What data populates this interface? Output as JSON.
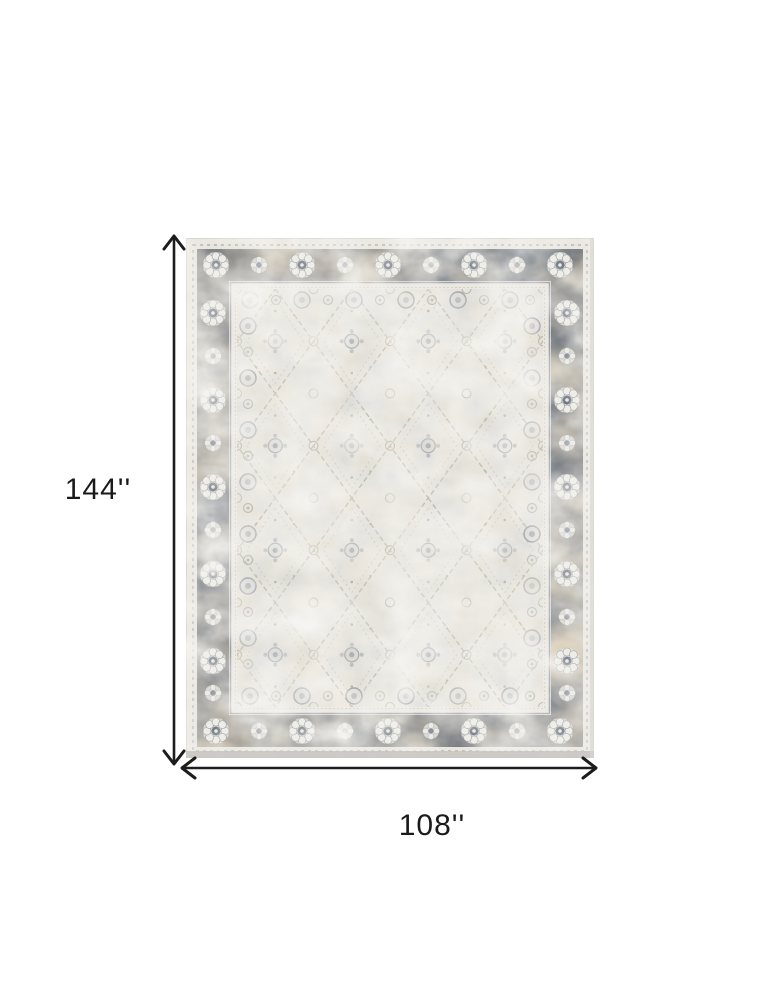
{
  "page": {
    "background": "#ffffff"
  },
  "diagram": {
    "height_label": "144''",
    "width_label": "108''",
    "arrow_color": "#1c1c1c",
    "label_color": "#1a1a1a",
    "rug": {
      "alt": "Distressed vintage oriental area rug with ivory field, diamond trellis pattern and charcoal-taupe floral rosette border",
      "colors": {
        "field_ivory": "#e8e5de",
        "border_charcoal": "#545d6a",
        "border_taupe": "#a8926e",
        "guard_slate": "#8e96a2",
        "motif_tan": "#b2a996",
        "motif_slate": "#8c97a4",
        "edge_shadow": "#c6c4c0"
      }
    }
  }
}
